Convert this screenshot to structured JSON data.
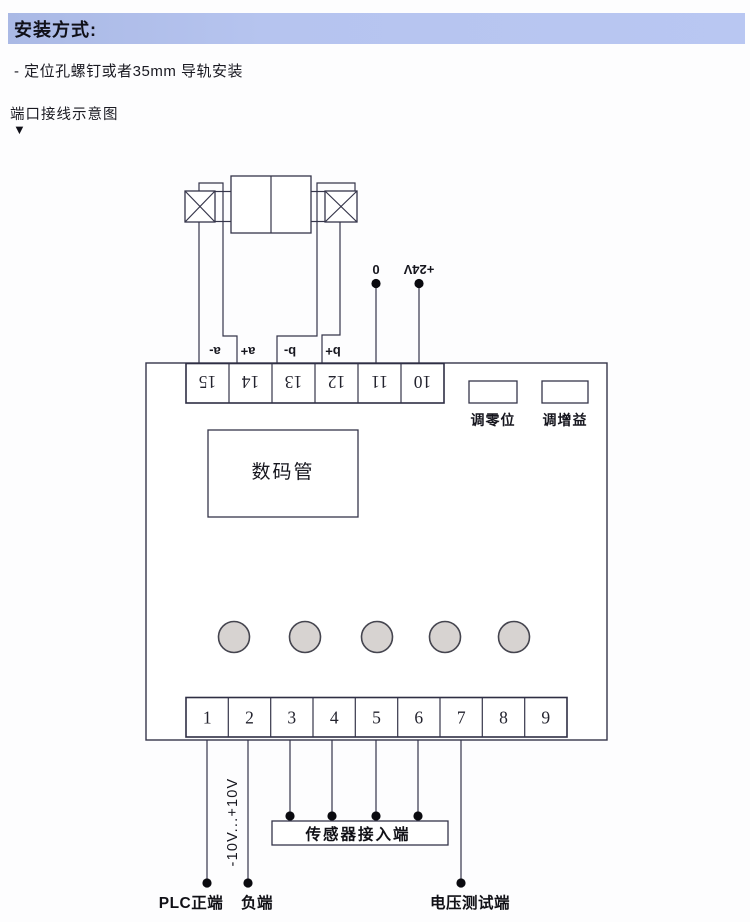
{
  "header": {
    "title": "安装方式:"
  },
  "intro": {
    "install_note": "- 定位孔螺钉或者35mm 导轨安装",
    "diagram_title": "端口接线示意图",
    "down_arrow": "▼"
  },
  "device": {
    "top_terminals": [
      "15",
      "14",
      "13",
      "12",
      "11",
      "10"
    ],
    "coil_labels": [
      "a-",
      "a+",
      "b-",
      "b+"
    ],
    "power_labels": {
      "zero": "0",
      "plus24v": "+24V"
    },
    "adjusters": {
      "zero": "调零位",
      "gain": "调增益"
    },
    "display": "数码管",
    "bottom_terminals": [
      "1",
      "2",
      "3",
      "4",
      "5",
      "6",
      "7",
      "8",
      "9"
    ]
  },
  "wiring": {
    "voltage_range": "-10V...+10V",
    "sensor_input": "传感器接入端",
    "plc_positive": "PLC正端",
    "negative": "负端",
    "voltage_test": "电压测试端"
  },
  "colors": {
    "header_bg_left": "#aab9e5",
    "header_bg_right": "#b9c7f2",
    "line": "#35354a",
    "button_fill": "#d7d3d1"
  }
}
